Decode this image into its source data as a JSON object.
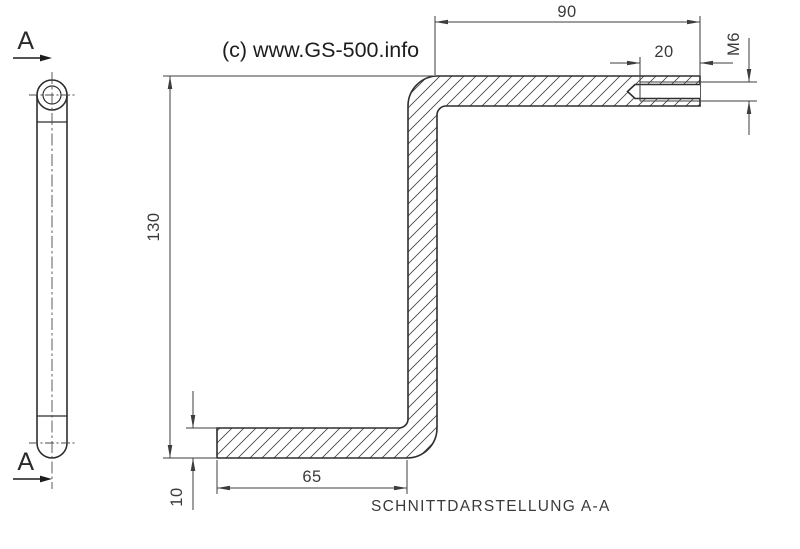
{
  "drawing": {
    "watermark": "(c) www.GS-500.info",
    "caption": "SCHNITTDARSTELLUNG A-A",
    "section_marks": {
      "top": "A",
      "bottom": "A"
    },
    "dimensions": {
      "top_arm_length": "90",
      "thread_depth": "20",
      "thread_size": "M6",
      "overall_height": "130",
      "bottom_arm_length": "65",
      "material_thickness": "10"
    },
    "colors": {
      "background": "#ffffff",
      "outline": "#2e2e2e",
      "dimension": "#3d3d3d",
      "hatch": "#4a4a4a"
    }
  }
}
